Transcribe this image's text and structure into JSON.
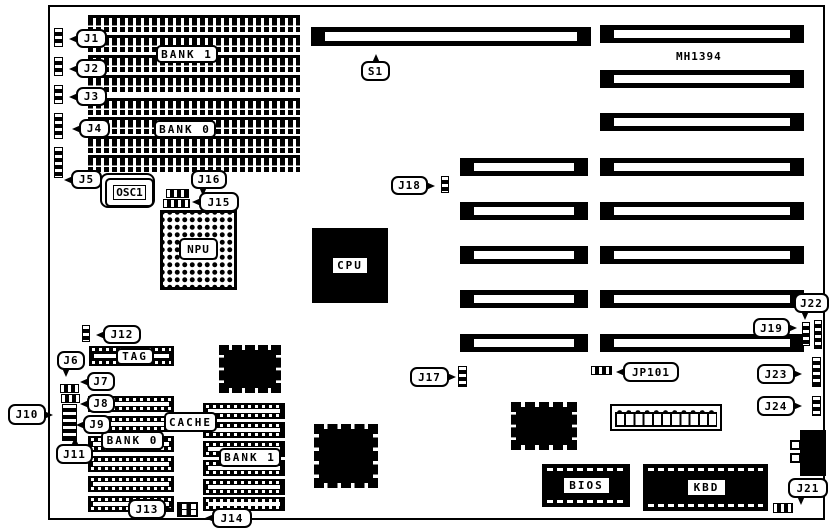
{
  "board": {
    "part_number": "MH1394"
  },
  "slots": {
    "s1": "S1"
  },
  "memory": {
    "bank1": "BANK 1",
    "bank0": "BANK 0"
  },
  "cache": {
    "tag": "TAG",
    "label": "CACHE",
    "bank0": "BANK 0",
    "bank1": "BANK 1"
  },
  "chips": {
    "cpu": "CPU",
    "npu": "NPU",
    "osc1": "OSC1",
    "bios": "BIOS",
    "kbd": "KBD"
  },
  "jumpers": {
    "j1": "J1",
    "j2": "J2",
    "j3": "J3",
    "j4": "J4",
    "j5": "J5",
    "j6": "J6",
    "j7": "J7",
    "j8": "J8",
    "j9": "J9",
    "j10": "J10",
    "j11": "J11",
    "j12": "J12",
    "j13": "J13",
    "j14": "J14",
    "j15": "J15",
    "j16": "J16",
    "j17": "J17",
    "j18": "J18",
    "j19": "J19",
    "j21": "J21",
    "j22": "J22",
    "j23": "J23",
    "j24": "J24",
    "jp101": "JP101"
  }
}
